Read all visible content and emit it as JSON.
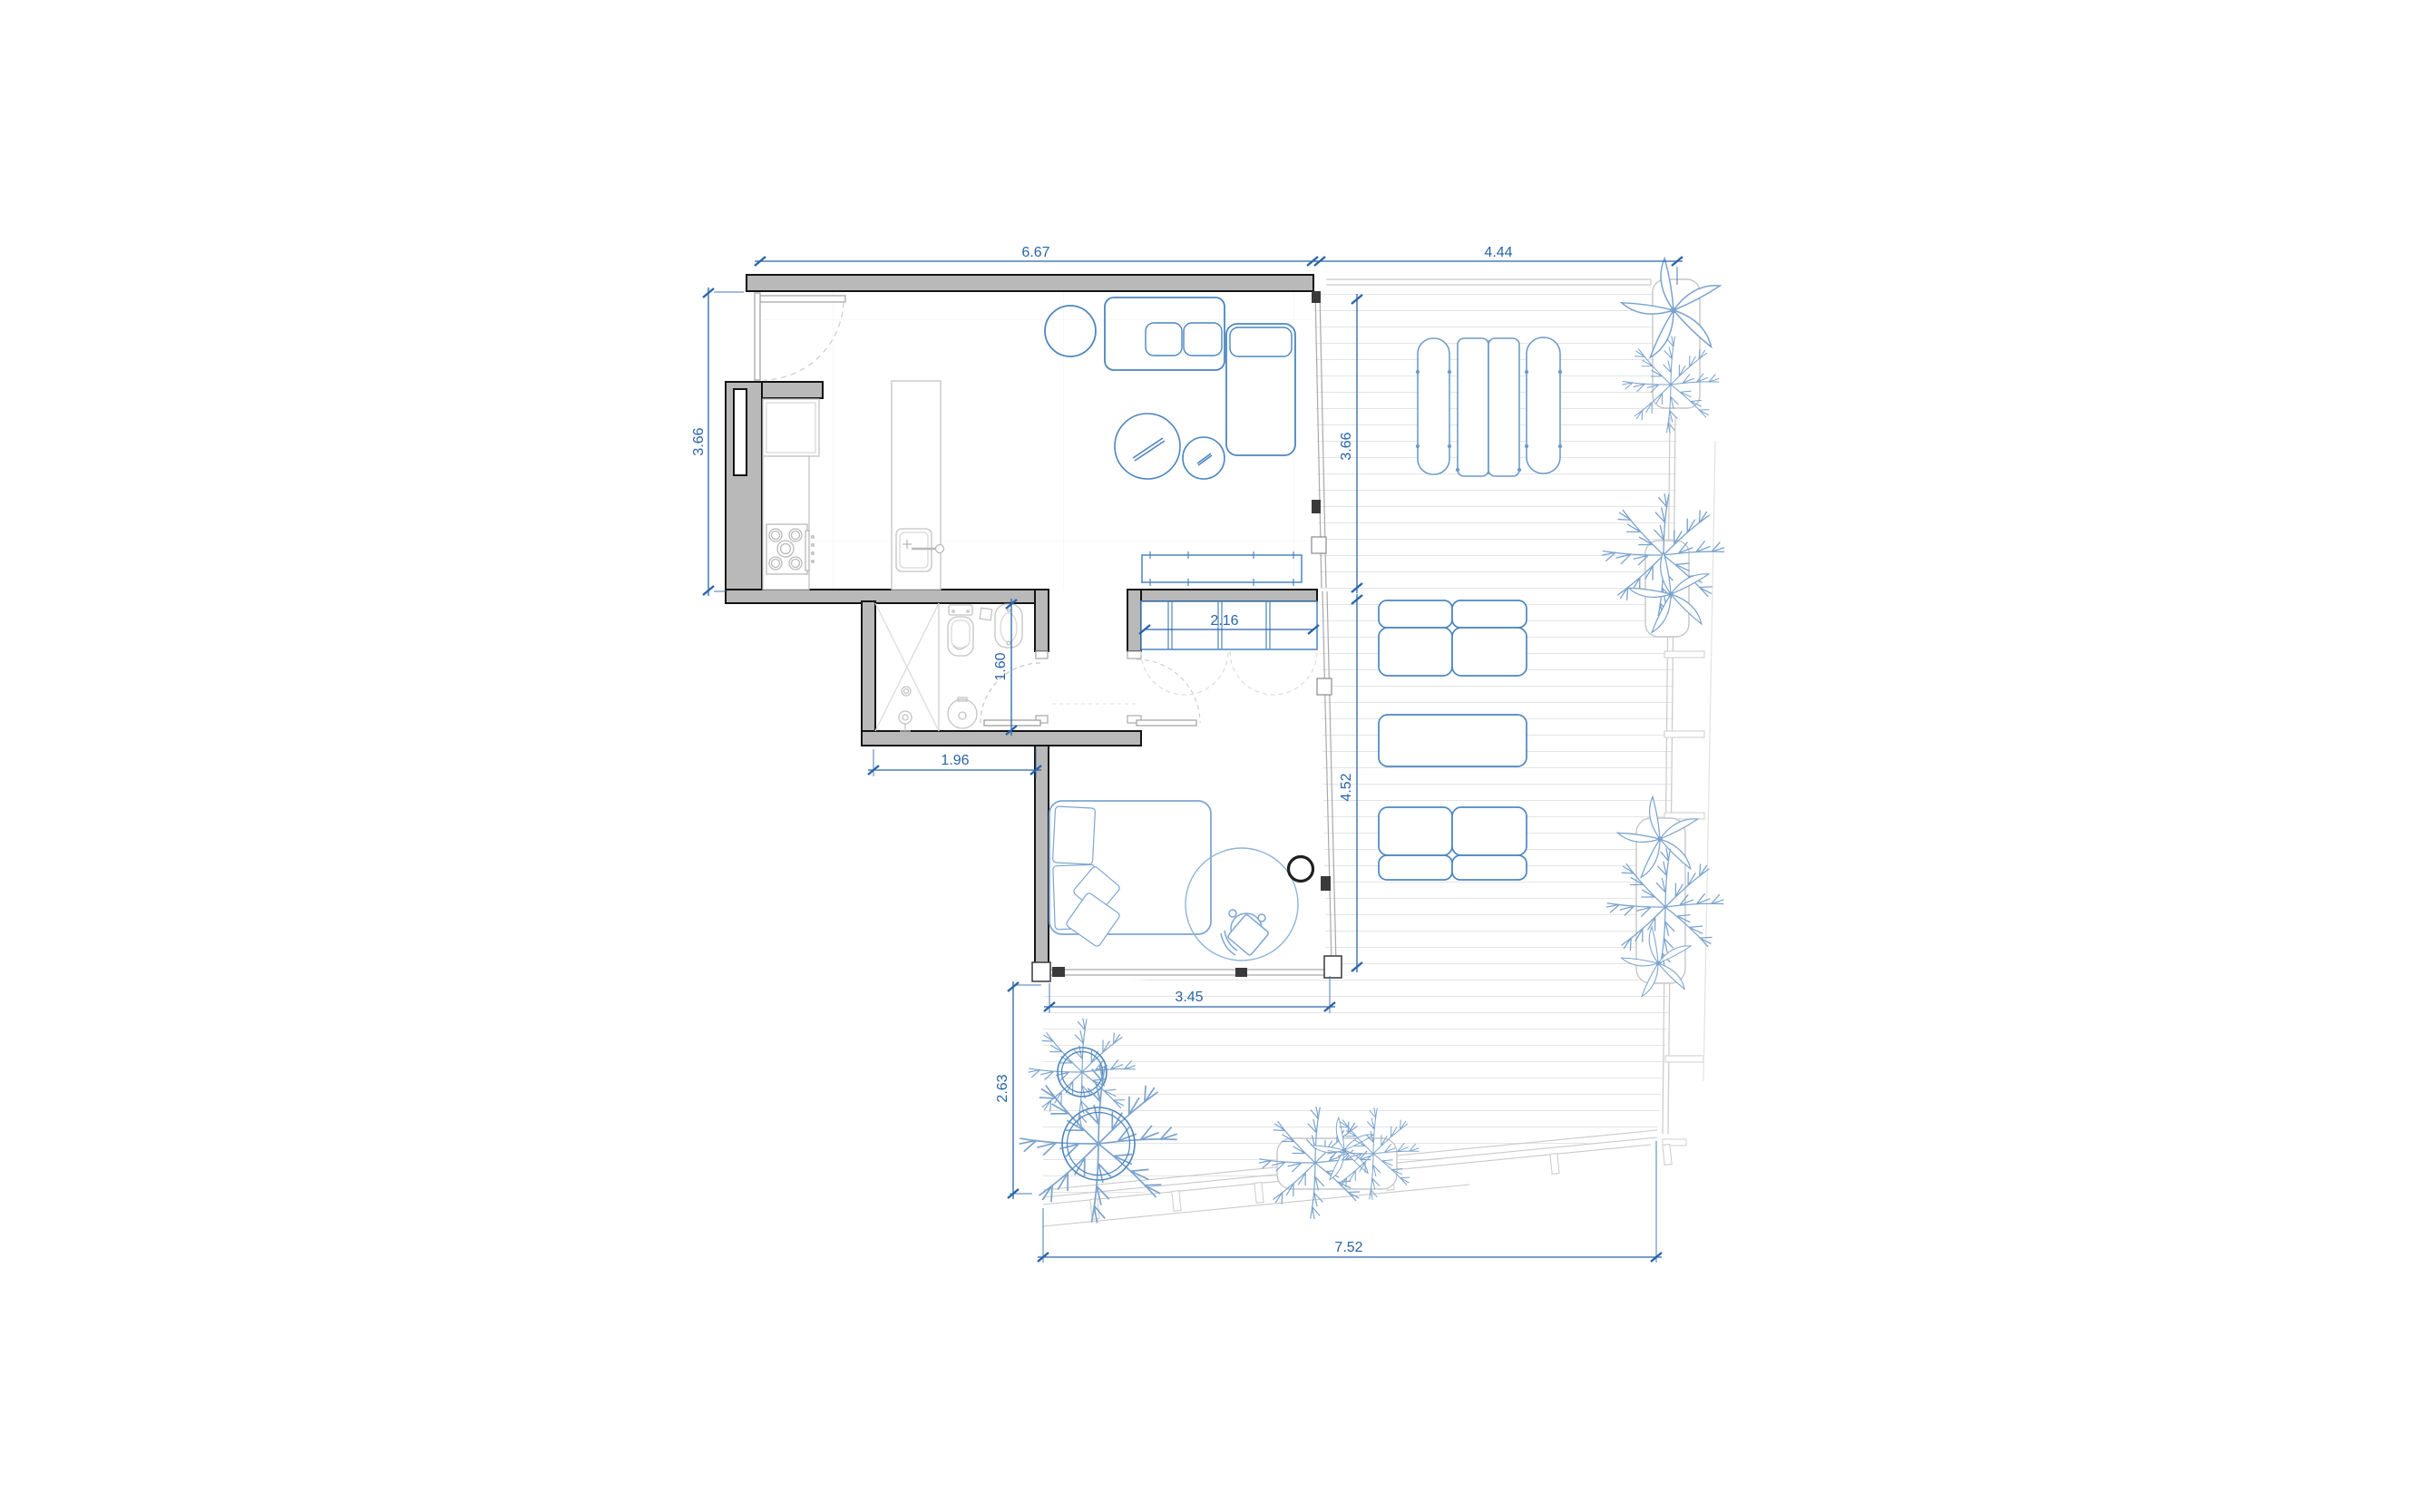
{
  "drawing": {
    "type": "architectural-floor-plan",
    "description": "one-bedroom apartment with kitchen island, bathroom, wardrobe, bedroom and large wooden deck terrace with planters and trees"
  },
  "dimensions": {
    "living_top": "6.67",
    "terrace_top": "4.44",
    "kitchen_left": "3.66",
    "terrace_right_upper": "3.66",
    "wardrobe": "2.16",
    "bathroom_inner_width": "1.60",
    "bathroom_outer_width": "1.96",
    "terrace_right_lower": "4.52",
    "bedroom_bottom": "3.45",
    "garden_left": "2.63",
    "garden_bottom": "7.52"
  },
  "colors": {
    "dimension_blue": "#2a64a8",
    "furniture_blue": "#4d86bf",
    "furniture_light_blue": "#7fa6d1",
    "plant_blue": "#7ba3cd",
    "wall_fill": "#b9b9b9",
    "wall_stroke": "#141414",
    "fixture_gray": "#c4c4c4",
    "deck_line": "#e3e3e3",
    "dark_accent": "#1f1f1f"
  }
}
